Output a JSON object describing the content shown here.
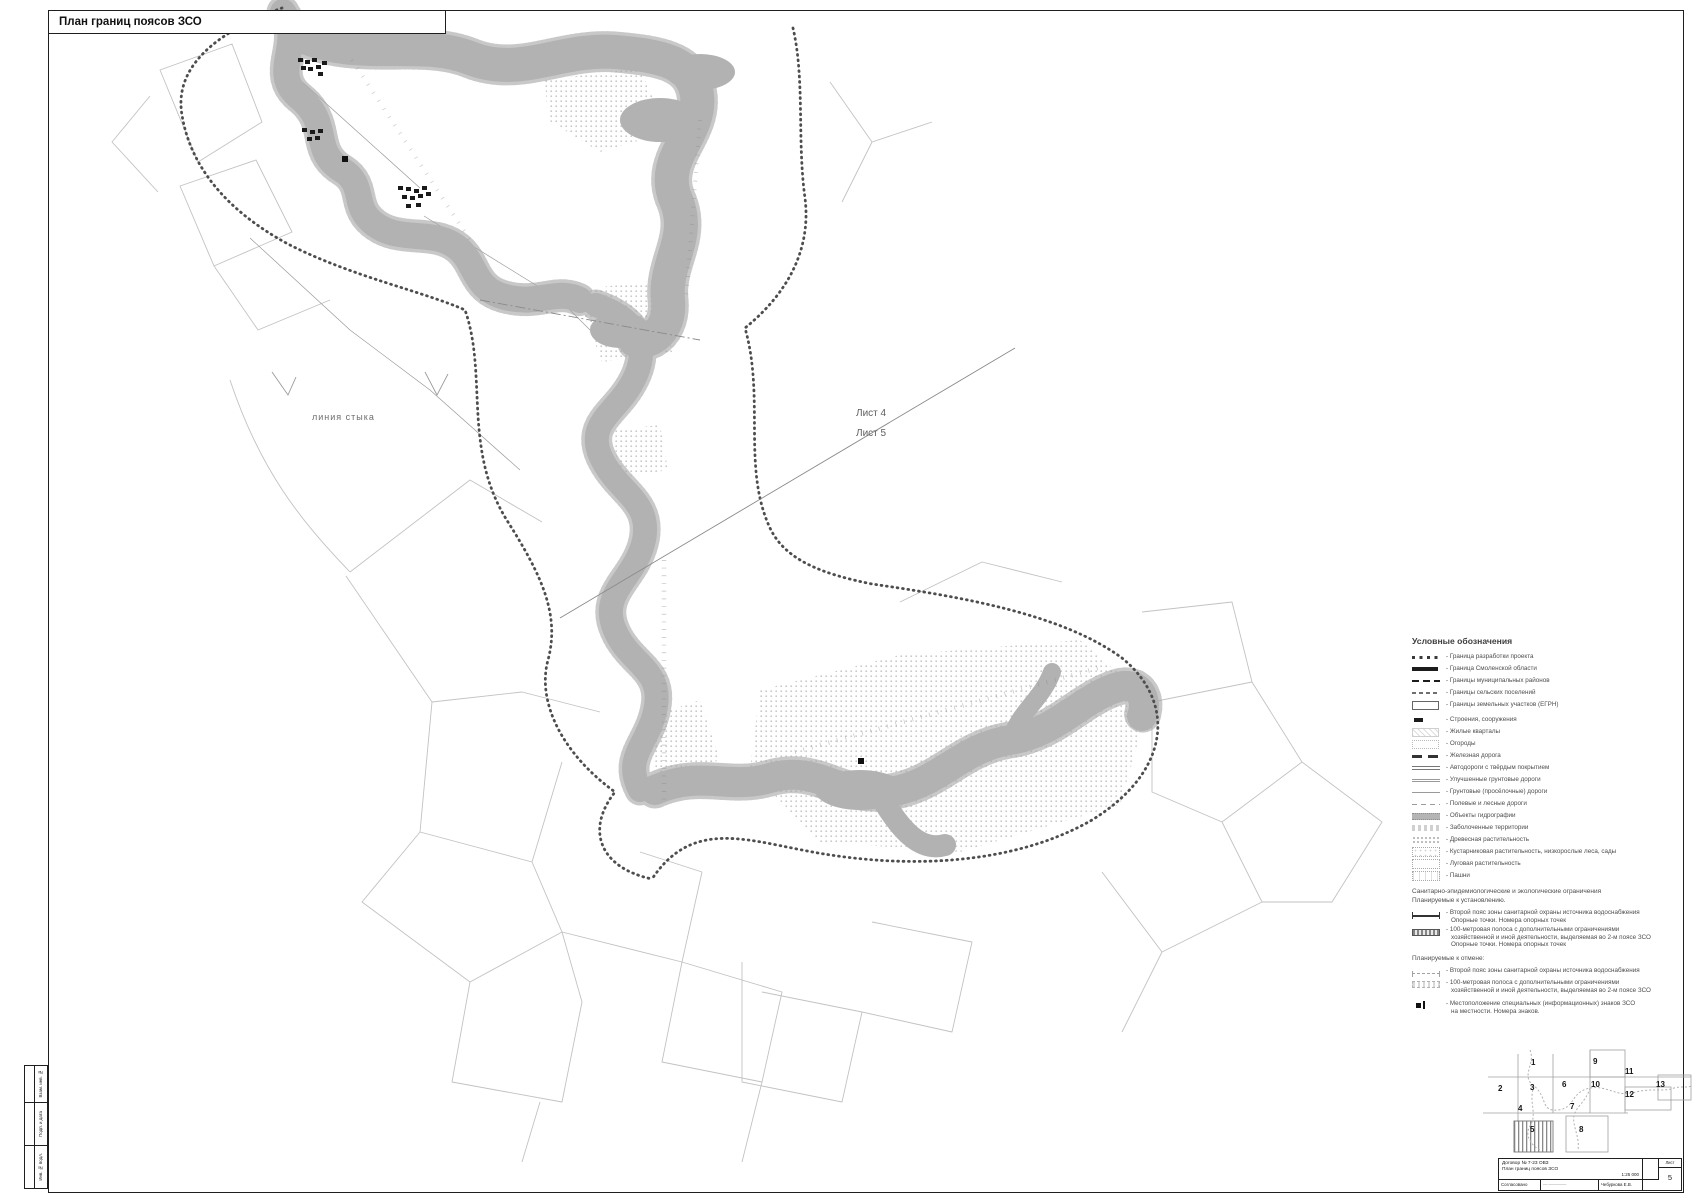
{
  "page": {
    "title": "План границ поясов ЗСО"
  },
  "colors": {
    "river_gray": "#b2b2b2",
    "speckle_gray": "#bdbdbd",
    "belt_boundary": "#4d4d4d",
    "frame_black": "#1f1f1f",
    "legend_text": "#4d4d4d"
  },
  "map_labels": {
    "seam": "линия стыка",
    "sheet4": "Лист 4",
    "sheet5": "Лист 5"
  },
  "legend": {
    "header": "Условные обозначения",
    "items": [
      {
        "label": "- Граница разработки проекта"
      },
      {
        "label": "- Граница Смоленской области"
      },
      {
        "label": "- Границы муниципальных районов"
      },
      {
        "label": "- Границы сельских поселений"
      },
      {
        "label": "- Границы земельных участков (ЕГРН)"
      },
      {
        "label": "- Строения, сооружения"
      },
      {
        "label": "- Жилые кварталы"
      },
      {
        "label": "- Огороды"
      },
      {
        "label": "- Железная дорога"
      },
      {
        "label": "- Автодороги с твёрдым покрытием"
      },
      {
        "label": "- Улучшенные грунтовые дороги"
      },
      {
        "label": "- Грунтовые (просёлочные) дороги"
      },
      {
        "label": "- Полевые и лесные дороги"
      },
      {
        "label": "- Объекты гидрографии"
      },
      {
        "label": "- Заболоченные территории"
      },
      {
        "label": "- Древесная растительность"
      },
      {
        "label": "- Кустарниковая растительность, низкорослые леса, сады"
      },
      {
        "label": "- Луговая растительность"
      },
      {
        "label": "- Пашни"
      }
    ],
    "sanitary_header": "Санитарно-эпидемиологические и экологические ограничения",
    "planned_establish": "Планируемые к установлению.",
    "establish": [
      {
        "line1": "- Второй пояс зоны санитарной охраны источника водоснабжения",
        "line2": "Опорные точки. Номера опорных точек"
      },
      {
        "line1": "- 100-метровая полоса с дополнительными ограничениями",
        "line2": "хозяйственной и иной деятельности, выделяемая во 2-м поясе ЗСО",
        "line3": "Опорные точки. Номера опорных точек"
      }
    ],
    "planned_cancel": "Планируемые к отмене:",
    "cancel": [
      {
        "line1": "- Второй пояс зоны санитарной охраны источника водоснабжения"
      },
      {
        "line1": "- 100-метровая полоса с дополнительными ограничениями",
        "line2": "хозяйственной и иной деятельности, выделяемая во 2-м поясе ЗСО"
      }
    ],
    "sign": {
      "line1": "- Местоположение специальных (информационных) знаков ЗСО",
      "line2": "на местности. Номера знаков."
    }
  },
  "sheet_index": {
    "sheets": [
      "1",
      "2",
      "3",
      "4",
      "5",
      "6",
      "7",
      "8",
      "9",
      "10",
      "11",
      "12",
      "13"
    ],
    "current": "5"
  },
  "title_block": {
    "doc_line1": "Договор № 7-23 ОВЗ",
    "doc_line2": "План границ поясов ЗСО",
    "scale": "1:25 000",
    "sheet_label": "Лист",
    "sheet_number": "5",
    "row_approved": "Согласовано",
    "row_signature": "Чебуркова Е.В."
  },
  "side_strip": {
    "cells": [
      "Взам. инв. №",
      "Подп. и дата",
      "Инв. № подл."
    ]
  }
}
